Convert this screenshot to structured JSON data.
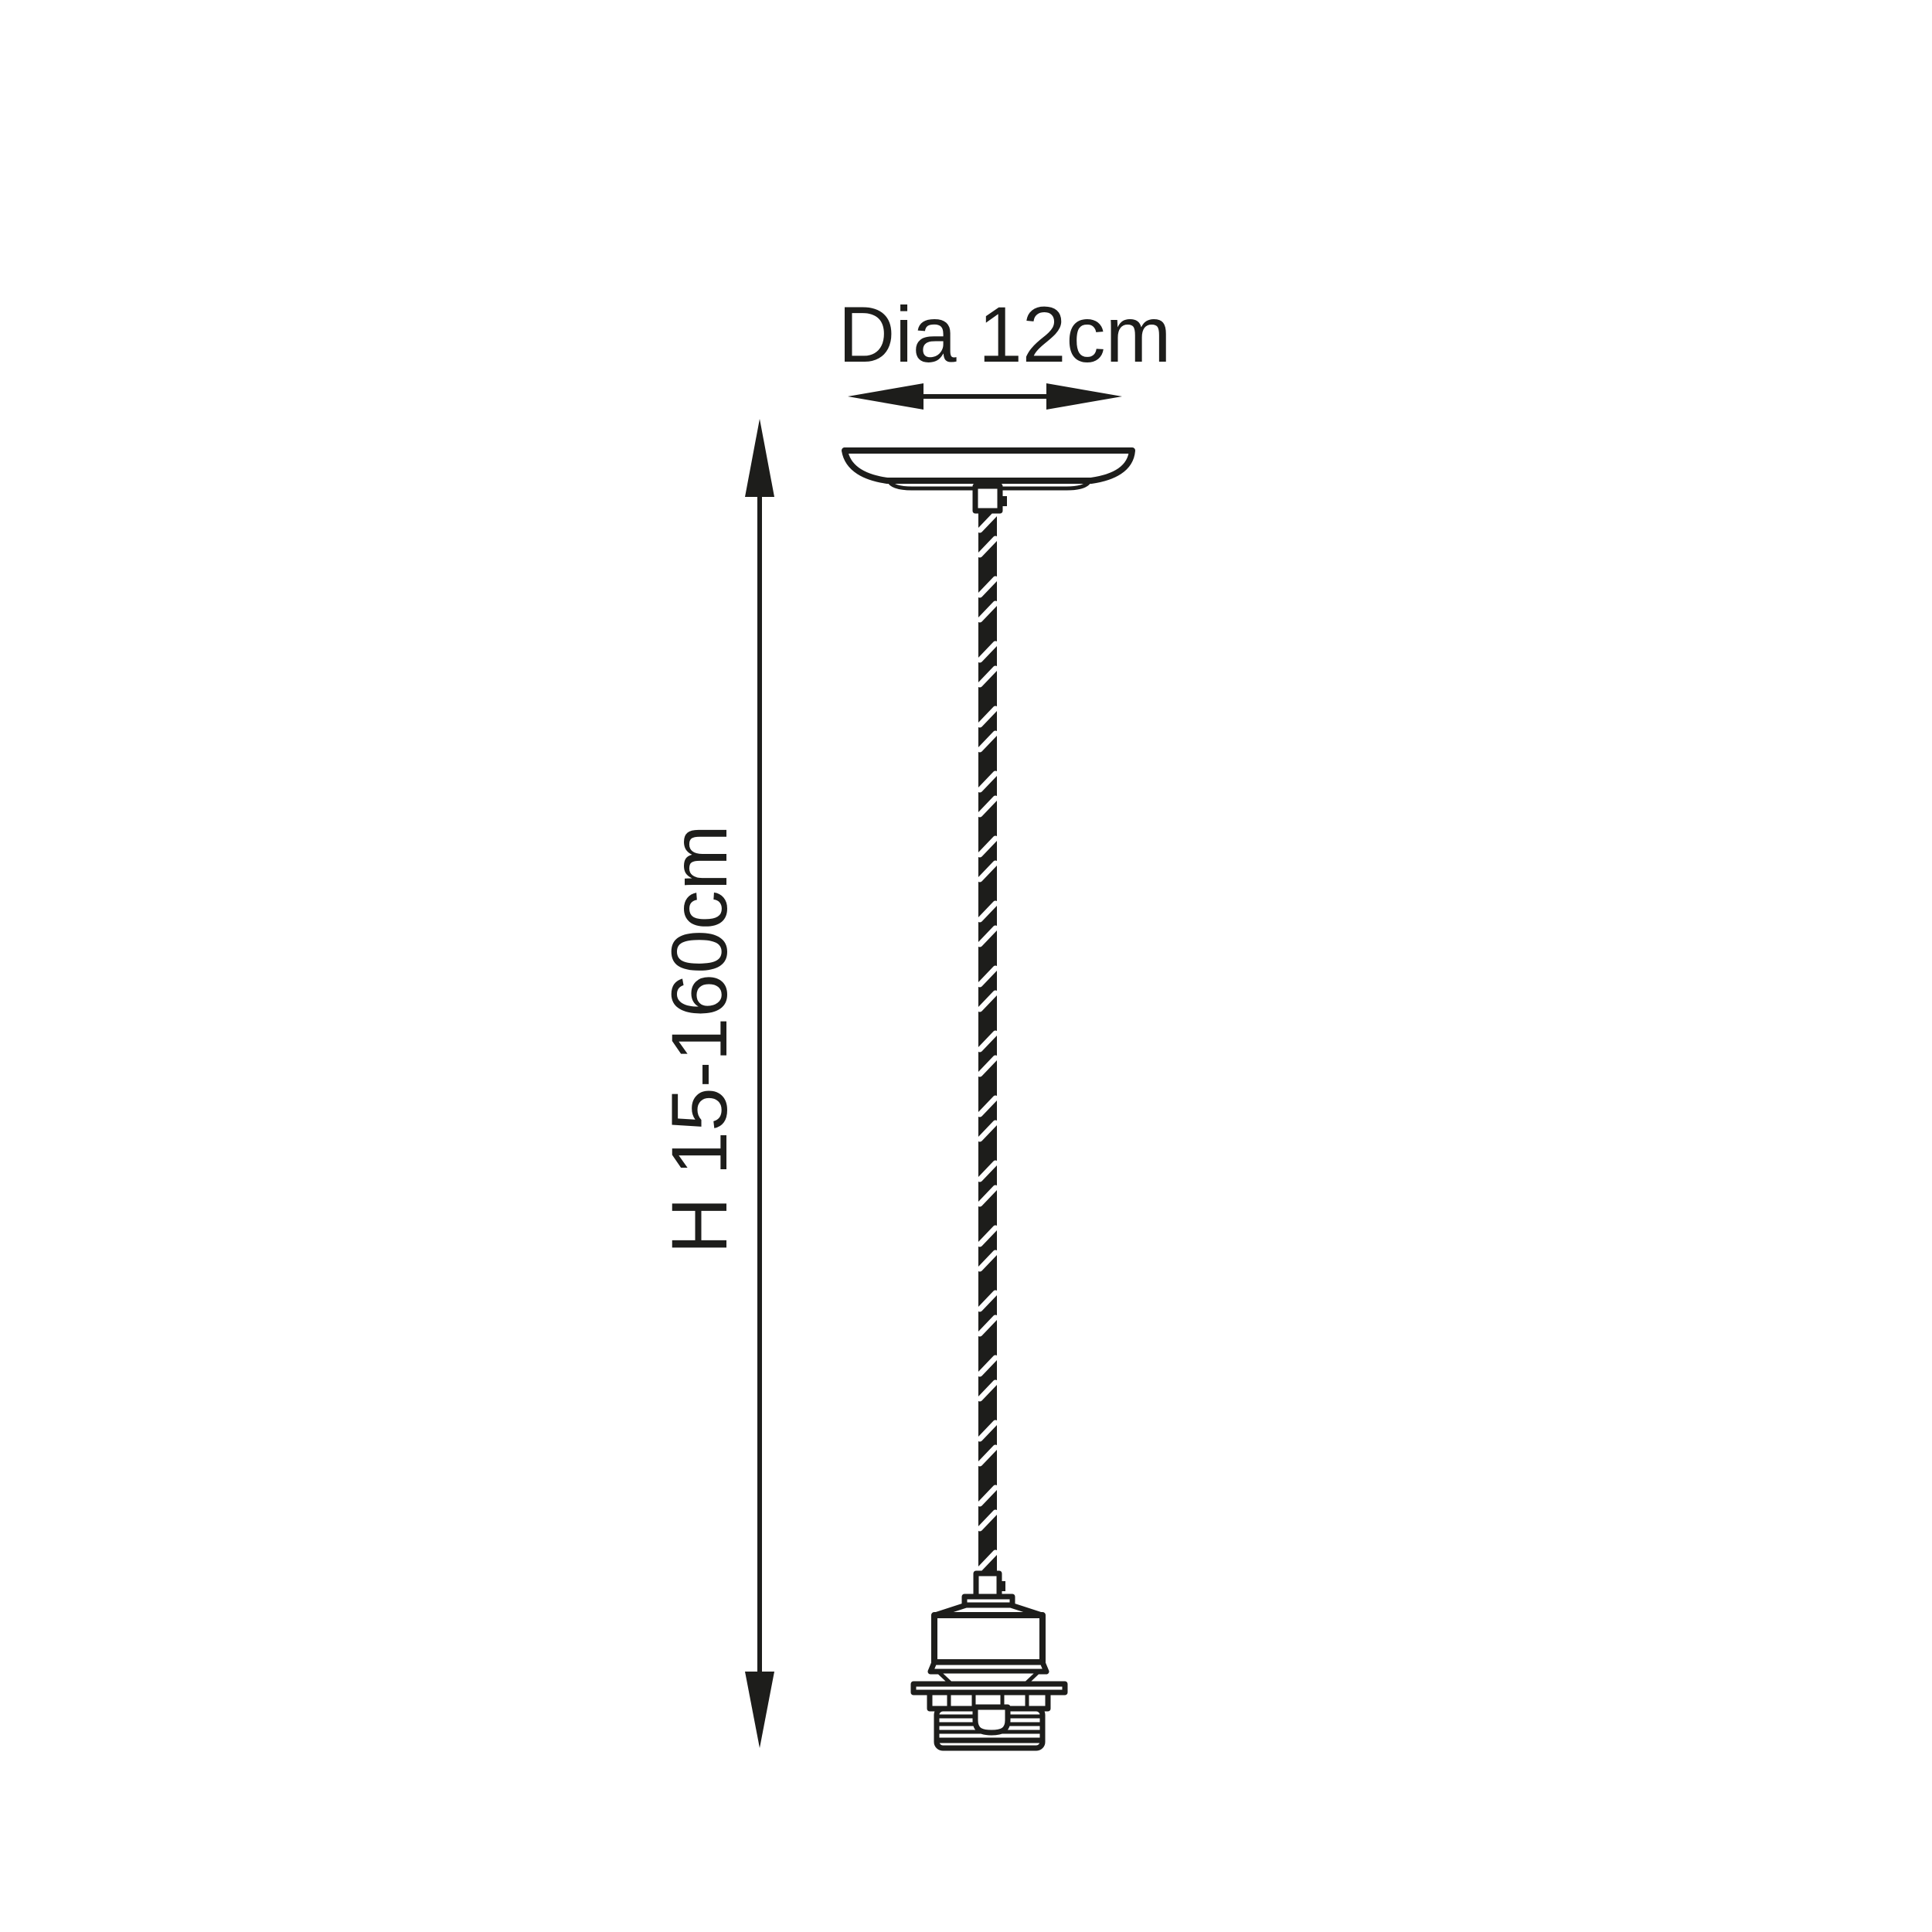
{
  "colors": {
    "ink": "#1d1d1b",
    "background": "#ffffff"
  },
  "labels": {
    "diameter": "Dia 12cm",
    "height": "H 15-160cm"
  }
}
